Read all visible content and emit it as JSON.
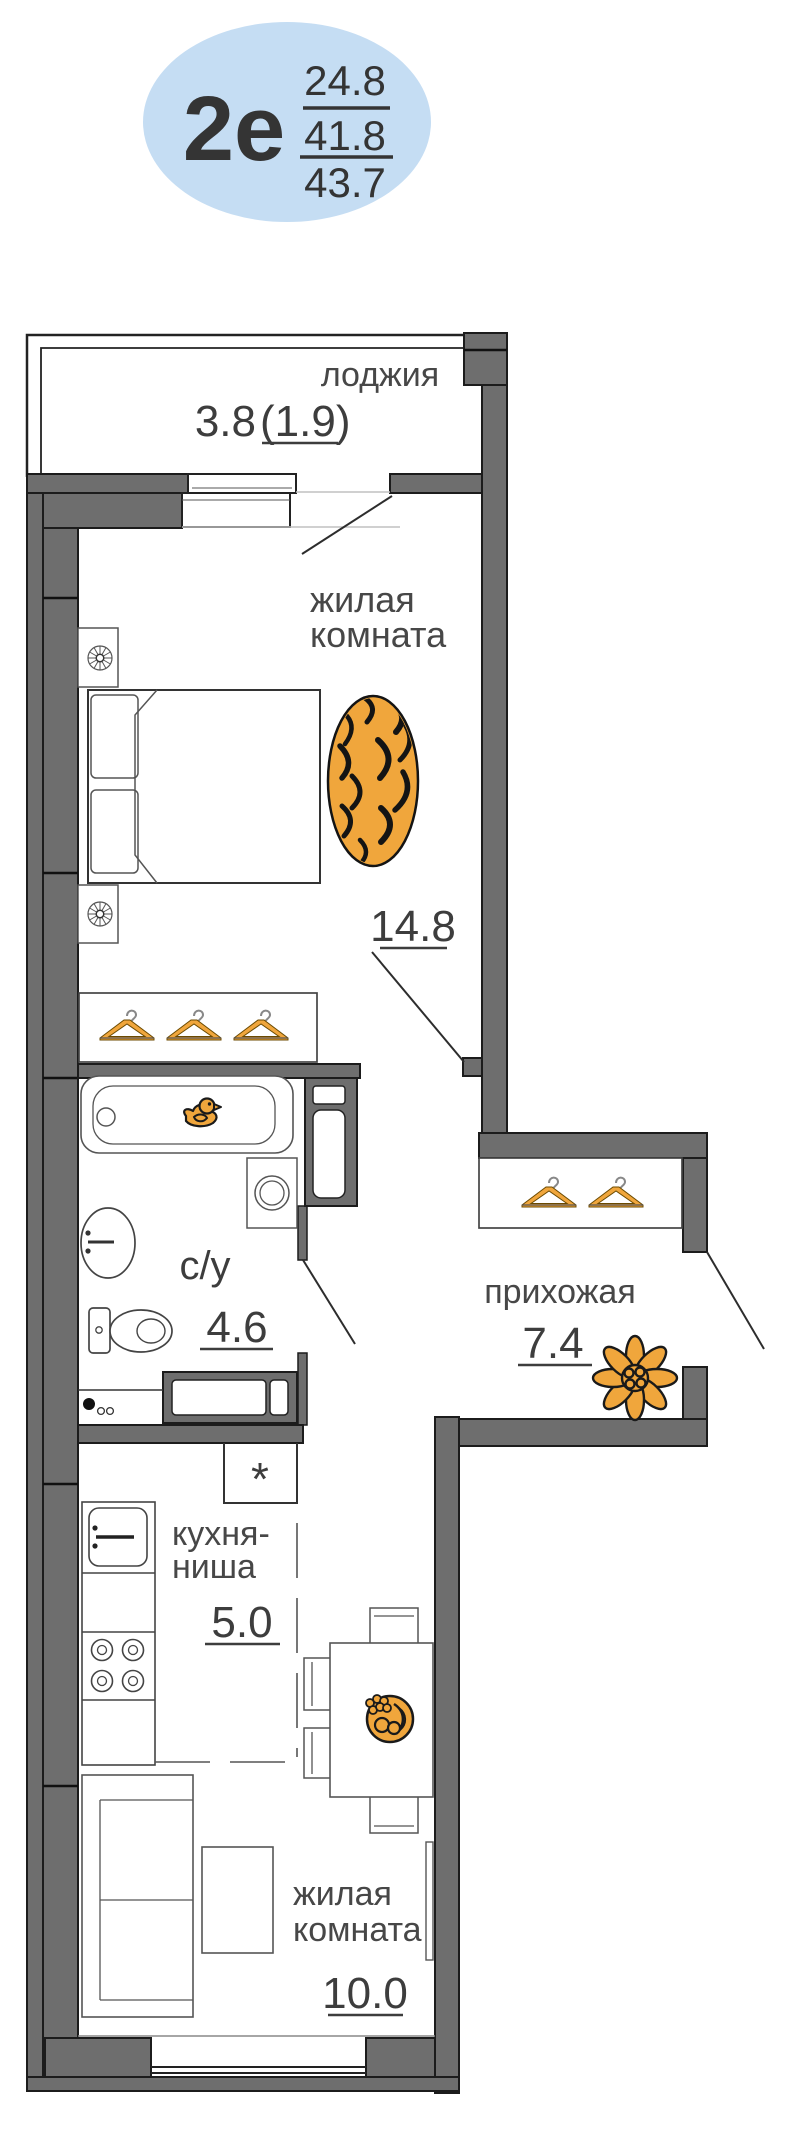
{
  "badge": {
    "type_label": "2е",
    "area_living": "24.8",
    "area_apartment": "41.8",
    "area_total": "43.7"
  },
  "rooms": {
    "loggia": {
      "name": "лоджия",
      "area": "3.8",
      "area_alt": "(1.9)"
    },
    "living_top": {
      "line1": "жилая",
      "line2": "комната",
      "area": "14.8"
    },
    "bathroom": {
      "name": "с/у",
      "area": "4.6"
    },
    "hallway": {
      "name": "прихожая",
      "area": "7.4"
    },
    "kitchen": {
      "line1": "кухня-",
      "line2": "ниша",
      "area": "5.0"
    },
    "storage": {
      "symbol": "*"
    },
    "living_bottom": {
      "line1": "жилая",
      "line2": "комната",
      "area": "10.0"
    }
  },
  "icons": {
    "rug": "tiger-rug-icon",
    "duck": "rubber-duck-icon",
    "hanger": "clothes-hanger-icon",
    "flower": "flower-icon",
    "fruit_plate": "fruit-plate-icon",
    "lamp": "lamp-icon"
  },
  "colors": {
    "wall_gray": "#6e6e6e",
    "outline_black": "#1c1c1c",
    "accent_orange": "#f0a63c",
    "badge_blue": "#c5ddf3",
    "text_gray": "#454545"
  }
}
